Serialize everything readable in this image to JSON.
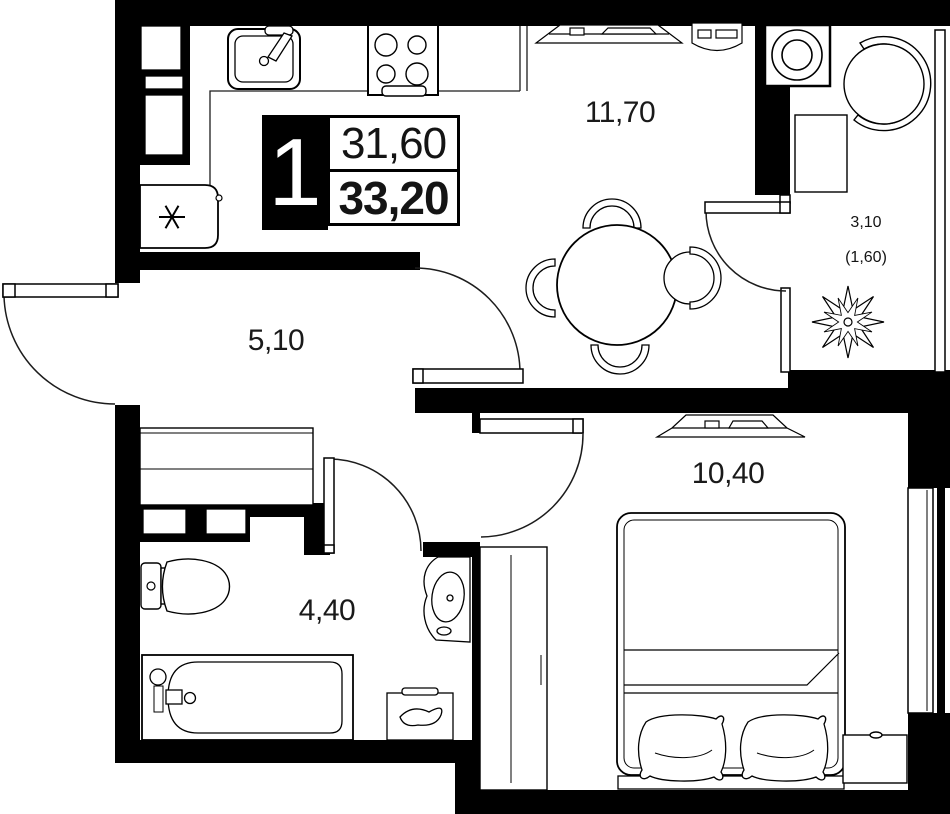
{
  "badge": {
    "number": "1",
    "value_top": "31,60",
    "value_bottom": "33,20"
  },
  "rooms": {
    "kitchen_living": "11,70",
    "balcony": "3,10",
    "balcony_reduced": "(1,60)",
    "hallway": "5,10",
    "bedroom": "10,40",
    "bathroom": "4,40"
  },
  "icons": {
    "fridge_snowflake": "✳"
  },
  "colors": {
    "wall": "#000000",
    "background": "#ffffff",
    "line": "#1c1c1c"
  }
}
